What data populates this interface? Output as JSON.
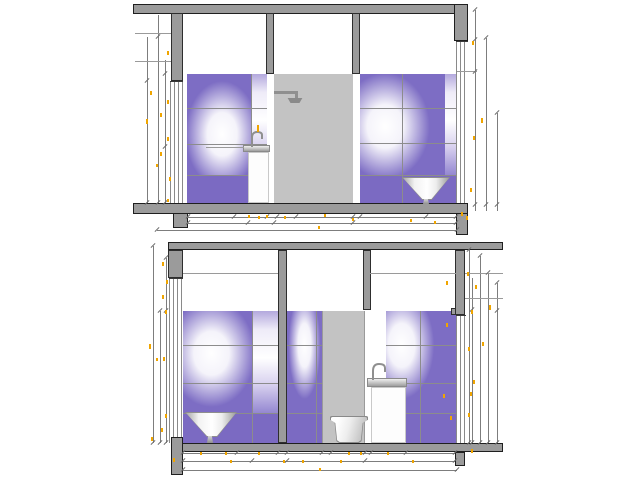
{
  "document": {
    "type": "architectural-elevation-drawing",
    "description": "Two bathroom interior elevation sections with tiled walls and sanitary fixtures"
  },
  "palette": {
    "bg": "#ffffff",
    "wall_fill": "#9b9b9b",
    "wall_outline": "#1f1f1f",
    "panel_fill": "#c3c3c3",
    "tile_purple": "#7d6dc4",
    "tile_solid": "#7b6ac2",
    "grid_line": "#8c8c8c",
    "dim_line": "#7d7d7d",
    "mark_yellow": "#f0a500",
    "fixture_white": "#fdfdfd",
    "metal_gray": "#8f8f8f"
  },
  "drawings": {
    "top": {
      "label": "upper-section",
      "fixtures": [
        "shower-head",
        "countertop-basin-with-cabinet",
        "cone-washbasin"
      ]
    },
    "bottom": {
      "label": "lower-section",
      "fixtures": [
        "cone-washbasin",
        "wall-hung-toilet",
        "pedestal-washbasin"
      ]
    }
  },
  "tiles": {
    "rooms": [
      {
        "x": 187,
        "y": 74,
        "w": 80,
        "h": 131,
        "rows": [
          108,
          144,
          175
        ],
        "cols": [
          251
        ],
        "solid_from": 175,
        "glow_x": 44,
        "glow_y": 46,
        "light": [
          251,
          267
        ]
      },
      {
        "x": 360,
        "y": 74,
        "w": 97,
        "h": 131,
        "rows": [
          108,
          143,
          175
        ],
        "cols": [
          402
        ],
        "solid_from": 175,
        "glow_x": 26,
        "glow_y": 40,
        "light": [
          445,
          457
        ]
      },
      {
        "x": 183,
        "y": 311,
        "w": 95,
        "h": 132,
        "rows": [
          345,
          383,
          413
        ],
        "cols": [
          252
        ],
        "solid_from": 413,
        "glow_x": 30,
        "glow_y": 32,
        "light": [
          252,
          278
        ]
      },
      {
        "x": 287,
        "y": 311,
        "w": 35,
        "h": 132,
        "rows": [
          345,
          383,
          413
        ],
        "cols": [
          316
        ],
        "solid_from": 413,
        "glow_x": 50,
        "glow_y": 26,
        "light": null
      },
      {
        "x": 386,
        "y": 311,
        "w": 71,
        "h": 132,
        "rows": [
          345,
          383,
          413
        ],
        "cols": [
          420
        ],
        "solid_from": 413,
        "glow_x": 22,
        "glow_y": 26,
        "light": null
      }
    ]
  },
  "dim_lines": [
    [
      186,
      217,
      270,
      "h"
    ],
    [
      186,
      223,
      270,
      "h"
    ],
    [
      157,
      230,
      300,
      "h"
    ],
    [
      147,
      37,
      166,
      "v"
    ],
    [
      158,
      15,
      188,
      "v"
    ],
    [
      165,
      60,
      143,
      "v"
    ],
    [
      475,
      10,
      201,
      "v"
    ],
    [
      486,
      38,
      173,
      "v"
    ],
    [
      497,
      113,
      98,
      "v"
    ],
    [
      183,
      453,
      272,
      "h"
    ],
    [
      183,
      461,
      272,
      "h"
    ],
    [
      183,
      470,
      274,
      "h"
    ],
    [
      153,
      246,
      197,
      "v"
    ],
    [
      160,
      311,
      132,
      "v"
    ],
    [
      166,
      258,
      185,
      "v"
    ],
    [
      469,
      250,
      193,
      "v"
    ],
    [
      472,
      278,
      165,
      "v"
    ],
    [
      480,
      256,
      187,
      "v"
    ],
    [
      488,
      273,
      170,
      "v"
    ],
    [
      497,
      283,
      160,
      "v"
    ]
  ],
  "wall_lines": [
    [
      135,
      33,
      36,
      "h"
    ],
    [
      135,
      61,
      36,
      "h"
    ],
    [
      457,
      71,
      20,
      "h"
    ],
    [
      206,
      147,
      38,
      "h"
    ],
    [
      183,
      273,
      95,
      "h"
    ],
    [
      370,
      273,
      86,
      "h"
    ],
    [
      465,
      273,
      38,
      "h"
    ],
    [
      465,
      298,
      38,
      "h"
    ]
  ],
  "ticks": [
    [
      188,
      217
    ],
    [
      234,
      217
    ],
    [
      267,
      217
    ],
    [
      277,
      217
    ],
    [
      296,
      217
    ],
    [
      353,
      217
    ],
    [
      360,
      217
    ],
    [
      426,
      217
    ],
    [
      456,
      217
    ],
    [
      188,
      223
    ],
    [
      248,
      223
    ],
    [
      274,
      223
    ],
    [
      353,
      223
    ],
    [
      456,
      223
    ],
    [
      157,
      230
    ],
    [
      457,
      230
    ],
    [
      147,
      81
    ],
    [
      147,
      203
    ],
    [
      158,
      37
    ],
    [
      158,
      203
    ],
    [
      165,
      74
    ],
    [
      165,
      147
    ],
    [
      165,
      203
    ],
    [
      475,
      10
    ],
    [
      475,
      40
    ],
    [
      475,
      72
    ],
    [
      475,
      205
    ],
    [
      486,
      38
    ],
    [
      486,
      205
    ],
    [
      497,
      113
    ],
    [
      497,
      205
    ],
    [
      183,
      453
    ],
    [
      237,
      453
    ],
    [
      278,
      453
    ],
    [
      287,
      453
    ],
    [
      322,
      453
    ],
    [
      331,
      453
    ],
    [
      365,
      453
    ],
    [
      371,
      453
    ],
    [
      406,
      453
    ],
    [
      455,
      453
    ],
    [
      183,
      461
    ],
    [
      252,
      461
    ],
    [
      287,
      461
    ],
    [
      365,
      461
    ],
    [
      455,
      461
    ],
    [
      183,
      470
    ],
    [
      457,
      470
    ],
    [
      153,
      246
    ],
    [
      153,
      443
    ],
    [
      166,
      258
    ],
    [
      166,
      311
    ],
    [
      166,
      443
    ],
    [
      160,
      311
    ],
    [
      160,
      443
    ],
    [
      469,
      250
    ],
    [
      469,
      443
    ],
    [
      472,
      310
    ],
    [
      472,
      443
    ],
    [
      480,
      256
    ],
    [
      480,
      443
    ],
    [
      488,
      273
    ],
    [
      488,
      443
    ],
    [
      497,
      283
    ],
    [
      497,
      311
    ],
    [
      497,
      443
    ]
  ],
  "marks": [
    [
      167,
      51,
      4
    ],
    [
      150,
      91,
      4
    ],
    [
      167,
      100,
      4
    ],
    [
      160,
      113,
      4
    ],
    [
      146,
      119,
      5
    ],
    [
      167,
      137,
      4
    ],
    [
      160,
      152,
      4
    ],
    [
      156,
      164,
      3
    ],
    [
      169,
      177,
      4
    ],
    [
      167,
      199,
      3
    ],
    [
      472,
      41,
      4
    ],
    [
      481,
      118,
      5
    ],
    [
      473,
      136,
      4
    ],
    [
      470,
      188,
      4
    ],
    [
      257,
      125,
      7
    ],
    [
      248,
      215,
      3
    ],
    [
      258,
      216,
      3
    ],
    [
      266,
      215,
      3
    ],
    [
      284,
      216,
      3
    ],
    [
      324,
      214,
      3
    ],
    [
      352,
      218,
      3
    ],
    [
      410,
      219,
      3
    ],
    [
      318,
      226,
      3
    ],
    [
      434,
      221,
      3
    ],
    [
      461,
      212,
      4
    ],
    [
      466,
      216,
      4
    ],
    [
      162,
      262,
      4
    ],
    [
      166,
      280,
      4
    ],
    [
      162,
      295,
      4
    ],
    [
      165,
      310,
      4
    ],
    [
      149,
      344,
      5
    ],
    [
      163,
      357,
      4
    ],
    [
      156,
      358,
      3
    ],
    [
      165,
      414,
      4
    ],
    [
      161,
      428,
      4
    ],
    [
      151,
      437,
      4
    ],
    [
      446,
      281,
      4
    ],
    [
      467,
      272,
      4
    ],
    [
      475,
      285,
      4
    ],
    [
      489,
      305,
      5
    ],
    [
      446,
      323,
      4
    ],
    [
      471,
      310,
      4
    ],
    [
      468,
      347,
      4
    ],
    [
      482,
      342,
      4
    ],
    [
      473,
      380,
      4
    ],
    [
      470,
      392,
      4
    ],
    [
      468,
      413,
      4
    ],
    [
      443,
      394,
      4
    ],
    [
      450,
      416,
      4
    ],
    [
      200,
      452,
      3
    ],
    [
      225,
      452,
      3
    ],
    [
      258,
      452,
      3
    ],
    [
      230,
      460,
      3
    ],
    [
      283,
      460,
      3
    ],
    [
      302,
      460,
      3
    ],
    [
      340,
      460,
      3
    ],
    [
      348,
      452,
      3
    ],
    [
      360,
      452,
      3
    ],
    [
      387,
      452,
      3
    ],
    [
      412,
      460,
      3
    ],
    [
      319,
      468,
      3
    ],
    [
      173,
      458,
      4
    ],
    [
      471,
      449,
      4
    ]
  ]
}
